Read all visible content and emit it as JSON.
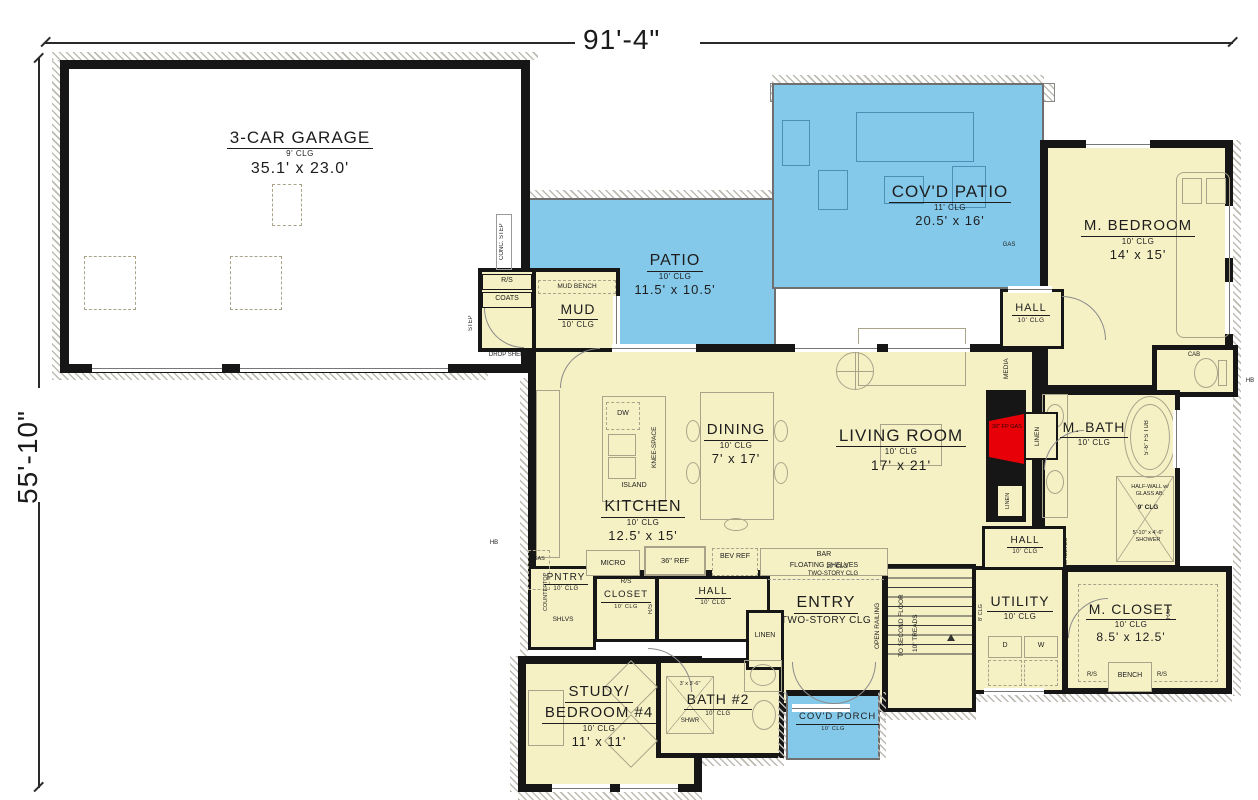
{
  "dimensions": {
    "width": "91'-4\"",
    "height": "55'-10\""
  },
  "colors": {
    "interior": "#f6f1c5",
    "patio_blue": "#85c9ea",
    "wall": "#161616",
    "fireplace_red": "#e80009",
    "hatch_gray": "#bdbbb2",
    "furniture_gray": "#a9a489"
  },
  "rooms": {
    "garage": {
      "name": "3-CAR GARAGE",
      "clg": "9' CLG",
      "dims": "35.1' x 23.0'"
    },
    "covd_patio": {
      "name": "COV'D PATIO",
      "clg": "11' CLG",
      "dims": "20.5' x 16'"
    },
    "patio": {
      "name": "PATIO",
      "clg": "10' CLG",
      "dims": "11.5' x 10.5'"
    },
    "m_bedroom": {
      "name": "M. BEDROOM",
      "clg": "10' CLG",
      "dims": "14' x 15'"
    },
    "mud": {
      "name": "MUD",
      "clg": "10' CLG"
    },
    "dining": {
      "name": "DINING",
      "clg": "10' CLG",
      "dims": "7' x 17'"
    },
    "living": {
      "name": "LIVING ROOM",
      "clg": "10' CLG",
      "dims": "17' x 21'"
    },
    "kitchen": {
      "name": "KITCHEN",
      "clg": "10' CLG",
      "dims": "12.5' x 15'"
    },
    "m_bath": {
      "name": "M. BATH",
      "clg": "10' CLG"
    },
    "hall_upper": {
      "name": "HALL",
      "clg": "10' CLG"
    },
    "hall_mid": {
      "name": "HALL",
      "clg": "10' CLG"
    },
    "hall_center": {
      "name": "HALL",
      "clg": "10' CLG"
    },
    "utility": {
      "name": "UTILITY",
      "clg": "10' CLG"
    },
    "m_closet": {
      "name": "M. CLOSET",
      "clg": "10' CLG",
      "dims": "8.5' x 12.5'"
    },
    "entry": {
      "name": "ENTRY",
      "clg": "TWO-STORY CLG"
    },
    "study": {
      "name1": "STUDY/",
      "name2": "BEDROOM #4",
      "clg": "10' CLG",
      "dims": "11' x 11'"
    },
    "bath2": {
      "name": "BATH #2",
      "clg": "10' CLG"
    },
    "covd_porch": {
      "name": "COV'D PORCH",
      "clg": "10' CLG"
    },
    "pntry": {
      "name": "PNTRY",
      "clg": "10' CLG"
    },
    "closet": {
      "name": "CLOSET",
      "clg": "10' CLG"
    }
  },
  "labels": {
    "rs": "R/S",
    "coats": "COATS",
    "mud_bench": "MUD BENCH",
    "drop_shelf": "DROP SHELF",
    "conc_step": "CONC. STEP",
    "step": "STEP",
    "dw": "DW",
    "knee_space": "KNEE-SPACE",
    "island": "ISLAND",
    "micro": "MICRO",
    "ref36": "36\" REF",
    "bev_ref": "BEV REF",
    "bar": "BAR",
    "floating_shelves": "FLOATING SHELVES",
    "gas": "GAS",
    "countertop": "COUNTERTOP",
    "shlvs": "SHLVS",
    "shelves": "SHELVES",
    "media": "MEDIA",
    "linen": "LINEN",
    "fireplace": "36\" FP GAS",
    "cab": "CAB",
    "hb": "HB",
    "tub": "5'-6\" FS TUB",
    "half_wall": "HALF-WALL w/ GLASS AB.",
    "shower9": "9' CLG",
    "shower_dims": "5'-10\" x 4'-6\" SHOWER",
    "open_railing": "OPEN RAILING",
    "to_second_floor": "TO SECOND FLOOR",
    "treads": "10\" TREADS",
    "break_top": "10' CLG",
    "break_bottom": "TWO-STORY CLG",
    "clg8": "8' CLG",
    "d": "D",
    "w": "W",
    "bench": "BENCH",
    "shwr_dims": "3' x 3'-6\"",
    "shwr": "SHWR"
  }
}
